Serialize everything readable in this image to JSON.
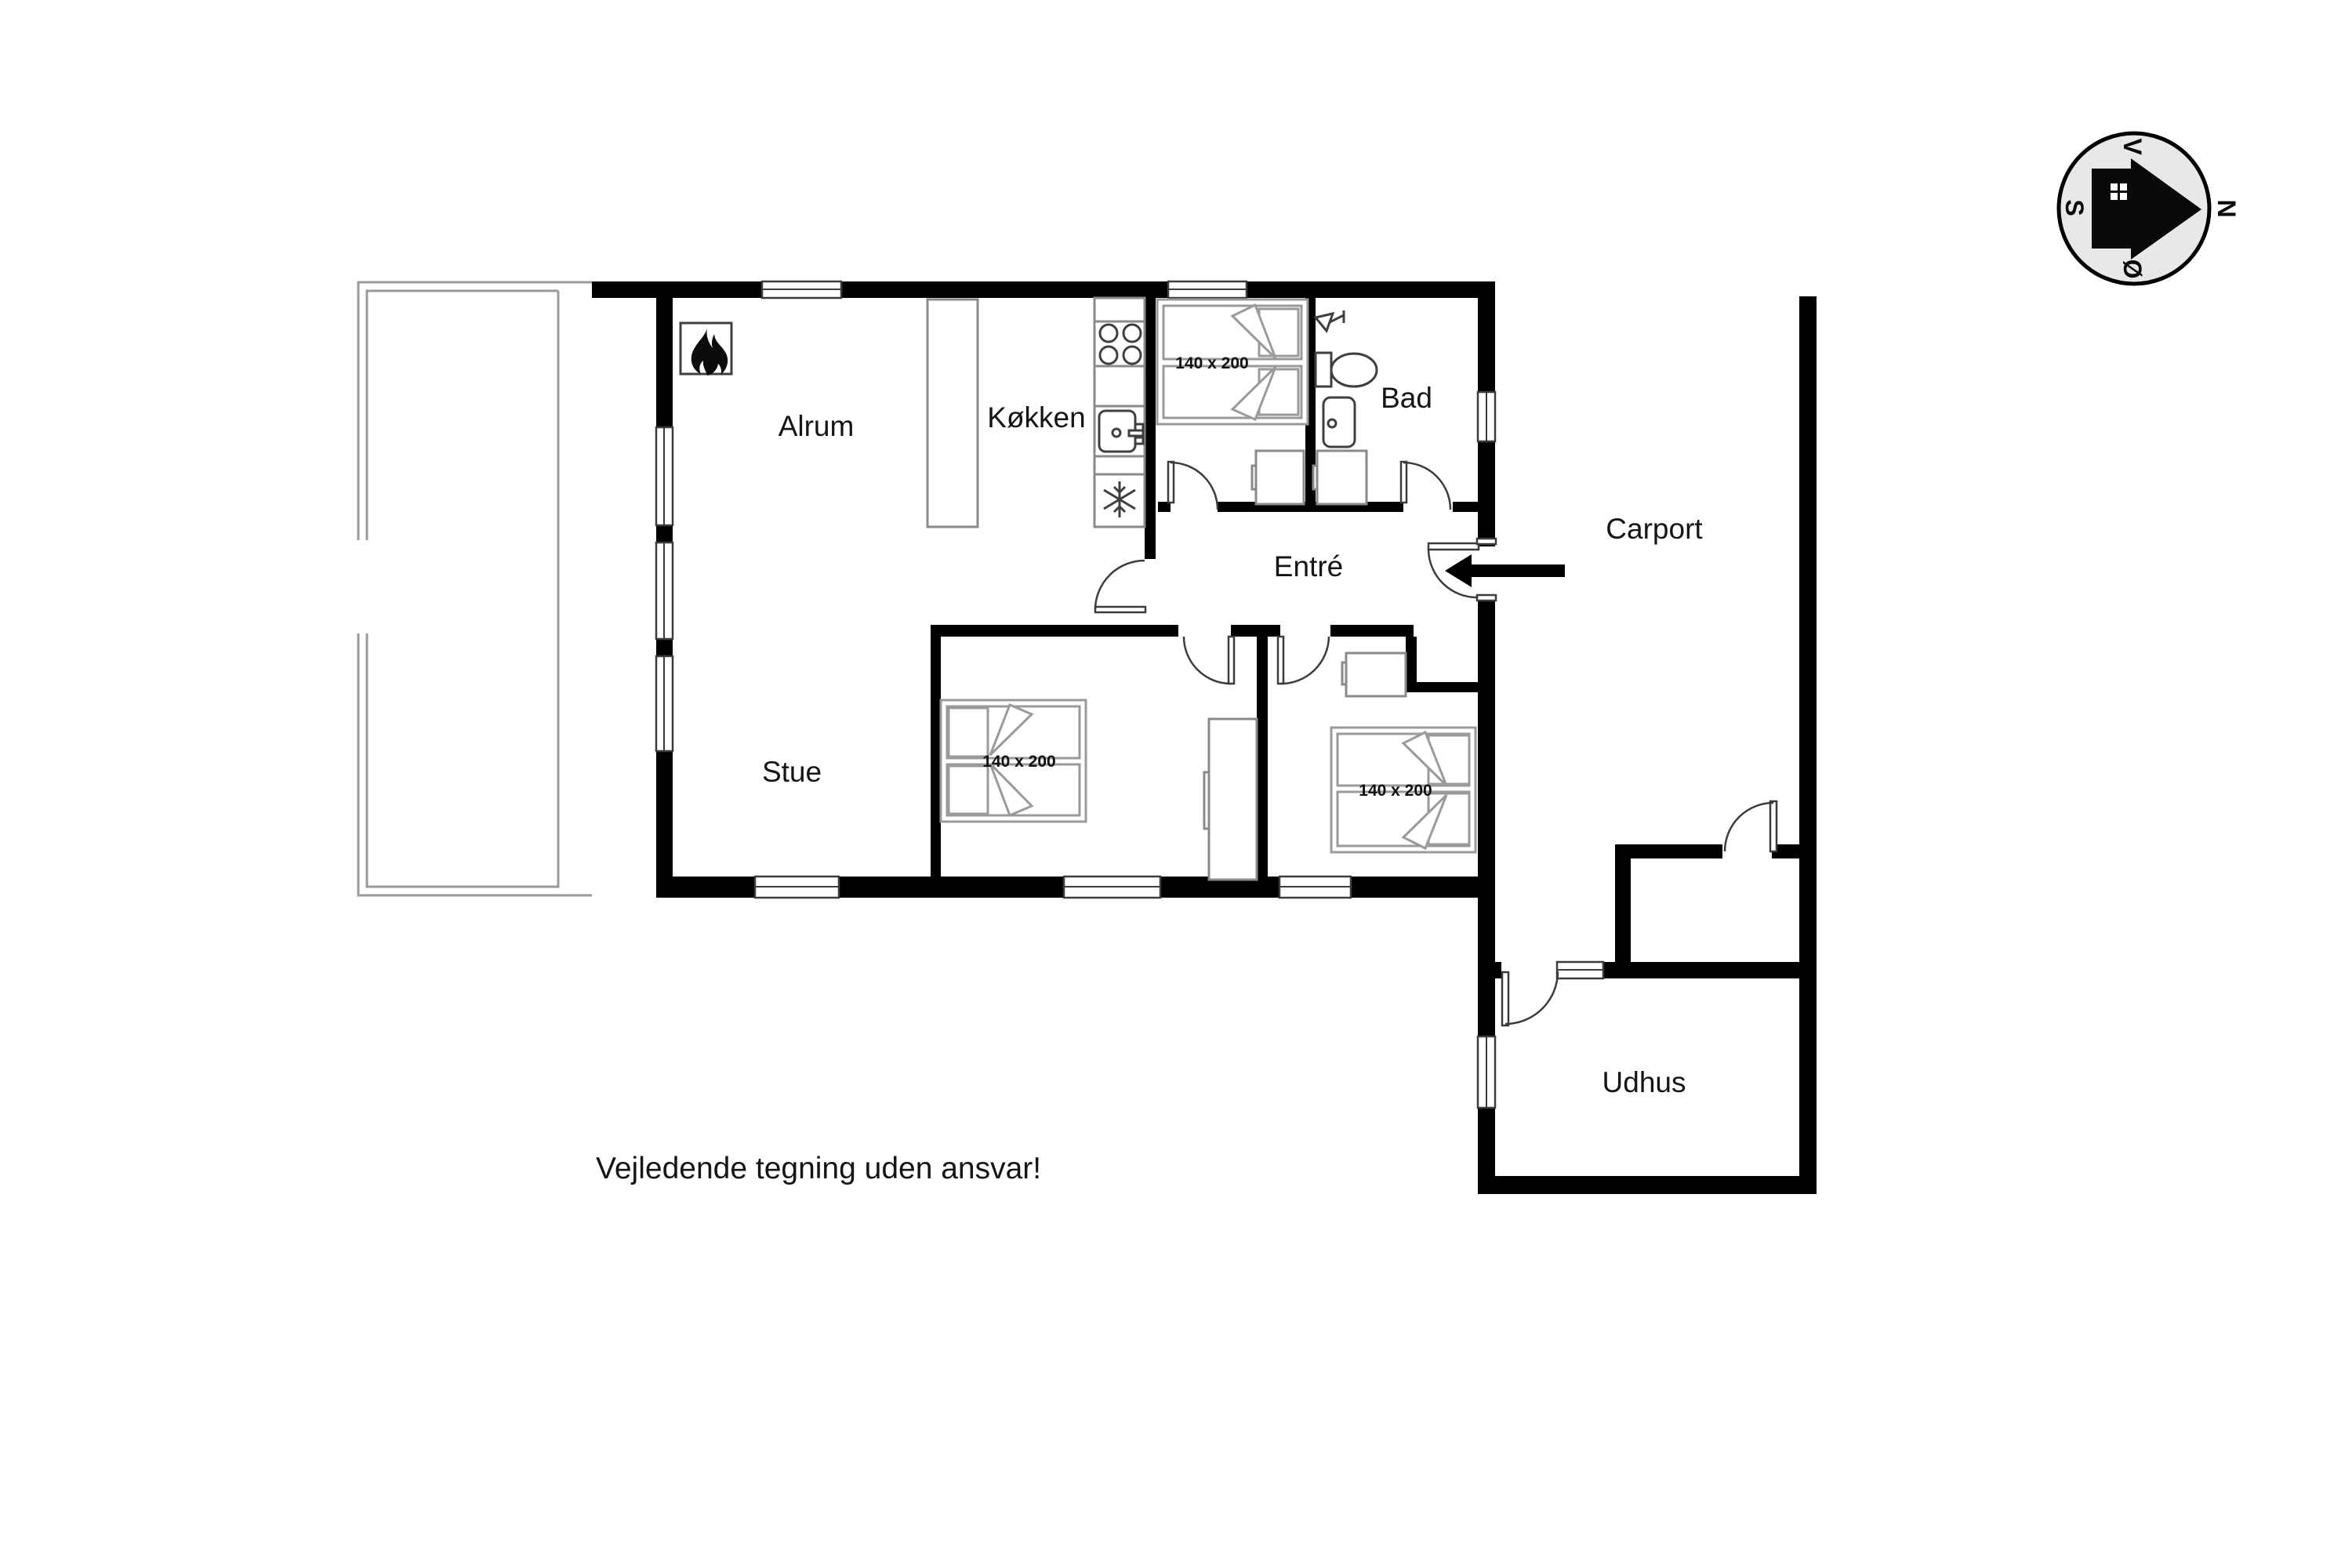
{
  "rooms": {
    "alrum": {
      "label": "Alrum"
    },
    "kokken": {
      "label": "Køkken"
    },
    "bad": {
      "label": "Bad"
    },
    "entre": {
      "label": "Entré"
    },
    "stue": {
      "label": "Stue"
    },
    "carport": {
      "label": "Carport"
    },
    "udhus": {
      "label": "Udhus"
    }
  },
  "beds": {
    "size_label": "140 x 200"
  },
  "disclaimer": "Vejledende tegning uden ansvar!",
  "compass": {
    "north": "N",
    "south": "S",
    "west": "V",
    "east": "Ø"
  },
  "icons": {
    "fireplace": "flame-icon",
    "freezer": "snowflake-icon",
    "stove": "stove-burners-icon",
    "kitchen_sink": "kitchen-sink-icon",
    "bath_sink": "bath-sink-icon",
    "toilet": "toilet-icon",
    "shower": "shower-icon",
    "entrance": "entrance-arrow-icon",
    "compass_rose": "compass-rose-icon"
  },
  "colors": {
    "wall": "#000000",
    "fixture_line": "#3f3f3f",
    "furniture_line": "#8a8a8a",
    "terrace_line": "#9a9a9a",
    "text": "#151515",
    "compass_fill": "#e8e8ea"
  }
}
